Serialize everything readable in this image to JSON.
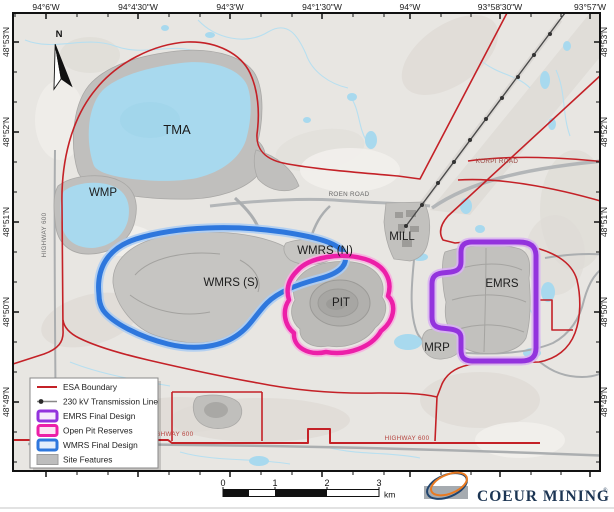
{
  "axis": {
    "top": [
      "94°6'W",
      "94°4'30\"W",
      "94°3'W",
      "94°1'30\"W",
      "94°W",
      "93°58'30\"W",
      "93°57'W"
    ],
    "left": [
      "48°53'N",
      "48°52'N",
      "48°51'N",
      "48°50'N",
      "48°49'N"
    ],
    "right": [
      "48°53'N",
      "48°52'N",
      "48°51'N",
      "48°50'N",
      "48°49'N"
    ]
  },
  "north": {
    "label": "N"
  },
  "areas": {
    "tma": "TMA",
    "wmp": "WMP",
    "wmrs_n": "WMRS (N)",
    "wmrs_s": "WMRS (S)",
    "pit": "PIT",
    "mill": "MILL",
    "emrs": "EMRS",
    "mrp": "MRP"
  },
  "roads": {
    "roen": "ROEN ROAD",
    "korpi": "KORPI ROAD",
    "highway_left": "HIGHWAY 600",
    "highway_bottom_left": "HIGHWAY 600",
    "highway_bottom_right": "HIGHWAY 600"
  },
  "legend": {
    "items": [
      {
        "label": "ESA Boundary",
        "swatch": "red-line"
      },
      {
        "label": "230 kV Transmission Line",
        "swatch": "dot-line"
      },
      {
        "label": "EMRS Final Design",
        "swatch": "purple-box"
      },
      {
        "label": "Open Pit Reserves",
        "swatch": "magenta-box"
      },
      {
        "label": "WMRS Final Design",
        "swatch": "blue-box"
      },
      {
        "label": "Site Features",
        "swatch": "gray-box"
      }
    ]
  },
  "scalebar": {
    "labels": [
      "0",
      "1",
      "2",
      "3"
    ],
    "unit": "km"
  },
  "branding": {
    "company": "COEUR MINING",
    "registered": "®"
  },
  "colors": {
    "esa_red": "#c42127",
    "transmission": "#4a4a4a",
    "emrs_purple": "#9333dd",
    "pit_magenta": "#ec1fa8",
    "wmrs_blue": "#2e77dd",
    "site_gray": "#bdbdbd",
    "water": "#a8d9ee"
  }
}
